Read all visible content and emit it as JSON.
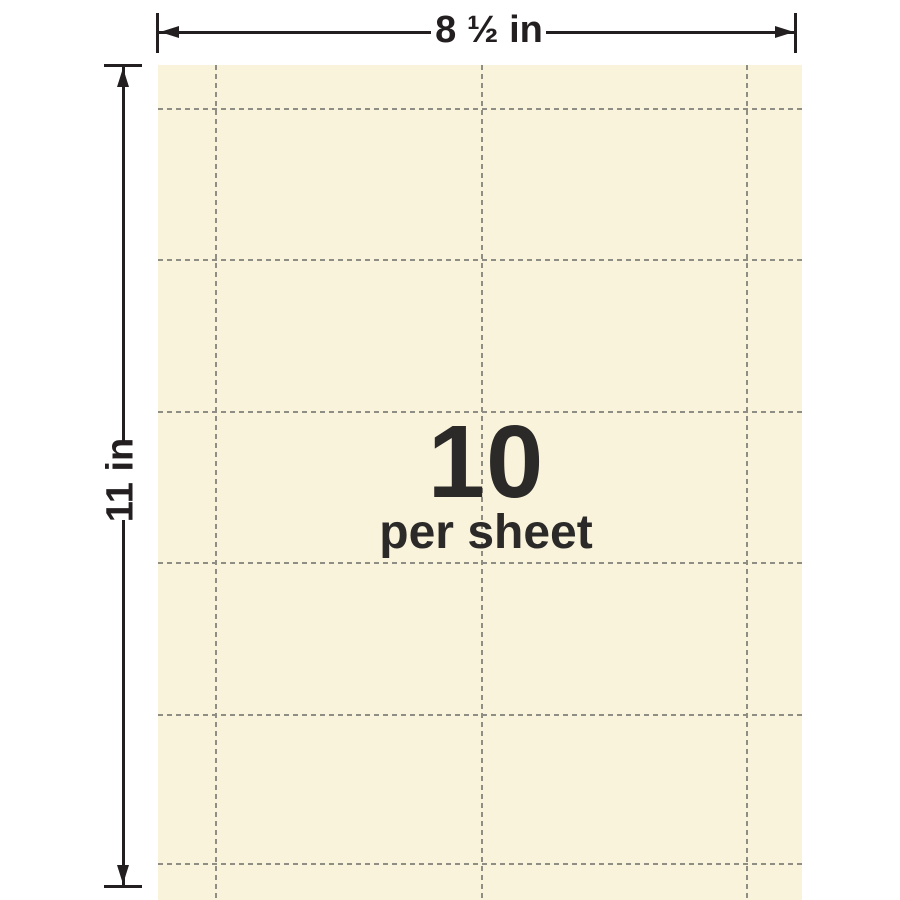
{
  "dimensions": {
    "width_label": "8 ½ in",
    "height_label": "11 in"
  },
  "sheet": {
    "count": "10",
    "count_caption": "per sheet",
    "grid": {
      "columns": 2,
      "rows": 5
    },
    "perforations": {
      "vertical_px": [
        57,
        323,
        588
      ],
      "horizontal_px": [
        43,
        194,
        346,
        497,
        649,
        798
      ]
    }
  },
  "colors": {
    "paper": "#FAF3DC",
    "perforation": "#8E8E85",
    "ink": "#231F20",
    "label_ink": "#2B2A28",
    "background": "#FFFFFF"
  }
}
